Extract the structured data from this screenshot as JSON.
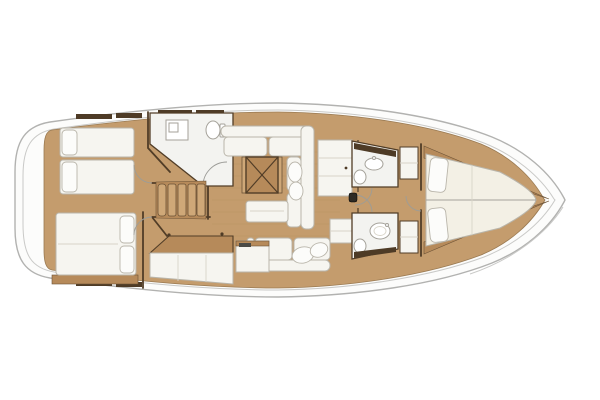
{
  "diagram": {
    "type": "floor-plan",
    "subject": "sailing-yacht-interior-top-view",
    "orientation": "bow-right",
    "rooms": [
      "aft-cabin-port",
      "aft-cabin-starboard",
      "aft-head",
      "companionway",
      "saloon",
      "galley",
      "forward-head-port",
      "forward-head-starboard",
      "forward-cabin"
    ]
  },
  "colors": {
    "background": "#ffffff",
    "hull": "#fcfcfb",
    "hull_stroke": "#b2b2b0",
    "deck_line": "#c9c9c7",
    "wood_floor": "#c49c6d",
    "wood_mid": "#b68a5a",
    "wood_edge": "#9a7a52",
    "wall_dark": "#513d27",
    "locker_dark": "#4e3b26",
    "furn_white": "#f6f5f0",
    "furn_stroke": "#b9b5aa",
    "room_white": "#f3f3f0",
    "bed_cream": "#f3f0e5",
    "pillow": "#fcfcfa",
    "fixture_stroke": "#a5a29a",
    "arc_gray": "#9c9c98",
    "seam": "#d8d4c8",
    "plank": "rgba(90,60,30,0.07)",
    "step_light": "#cfa878",
    "step_edge": "#6b5236",
    "mast_dark": "#2e2a24"
  }
}
